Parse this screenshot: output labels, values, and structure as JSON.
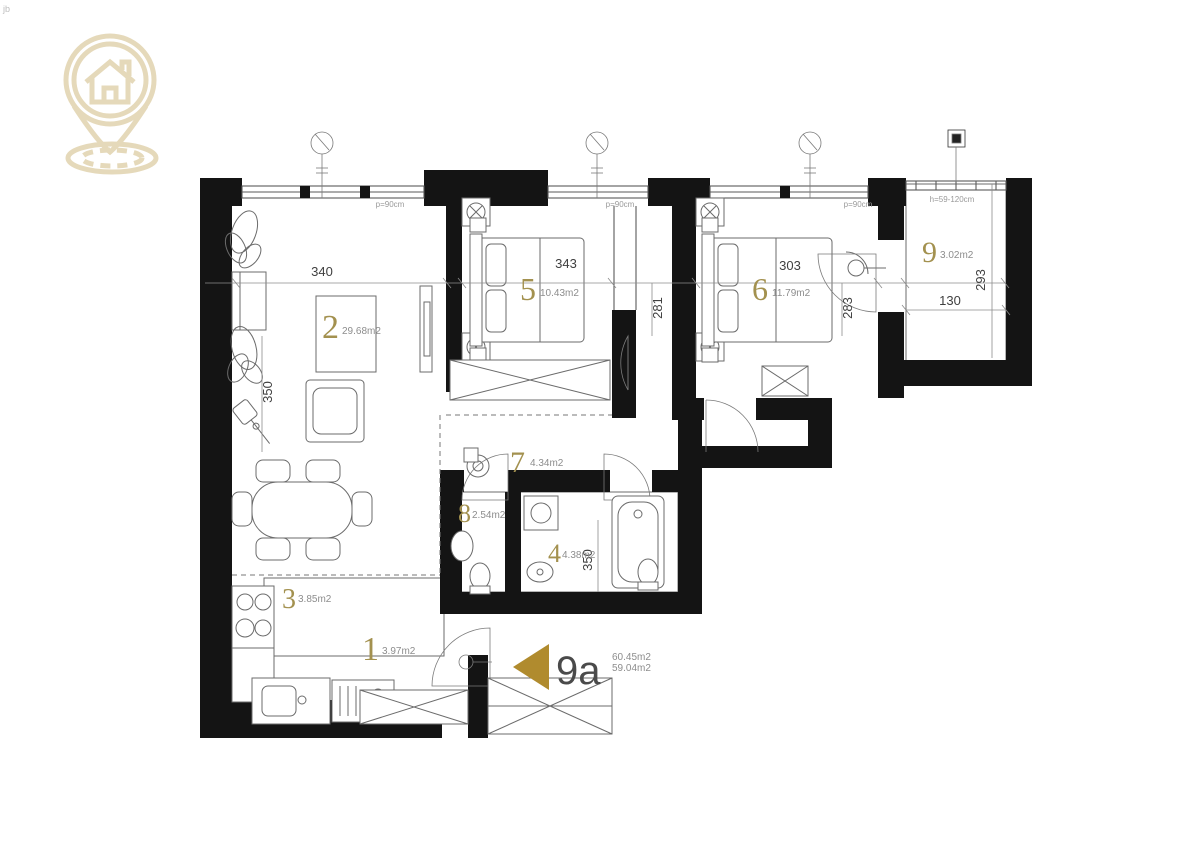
{
  "watermark": "jb",
  "logo": {
    "name": "house-location-pin-logo",
    "color": "#e5d9ba"
  },
  "unit": {
    "label": "9a",
    "area_line1": "60.45m2",
    "area_line2": "59.04m2",
    "arrow_color": "#b08b2e"
  },
  "rooms": {
    "r1": {
      "num": "1",
      "area": "3.97m2"
    },
    "r2": {
      "num": "2",
      "area": "29.68m2"
    },
    "r3": {
      "num": "3",
      "area": "3.85m2"
    },
    "r4": {
      "num": "4",
      "area": "4.38m2"
    },
    "r5": {
      "num": "5",
      "area": "10.43m2"
    },
    "r6": {
      "num": "6",
      "area": "11.79m2"
    },
    "r7": {
      "num": "7",
      "area": "4.34m2"
    },
    "r8": {
      "num": "8",
      "area": "2.54m2"
    },
    "r9": {
      "num": "9",
      "area": "3.02m2"
    }
  },
  "dims": {
    "living_w": "340",
    "r5_w": "343",
    "r6_w": "303",
    "terr_w": "130",
    "terr_h": "293",
    "r5_h": "281",
    "r6_h": "283",
    "left_h": "350",
    "bath_h": "350"
  },
  "notes": {
    "win1": "p=90cm",
    "win2": "p=90cm",
    "win3": "p=90cm",
    "terrace": "h=59-120cm"
  },
  "colors": {
    "gold": "#a3914f",
    "wall": "#141414",
    "logo": "#e5d9ba",
    "arrow": "#b08b2e"
  }
}
